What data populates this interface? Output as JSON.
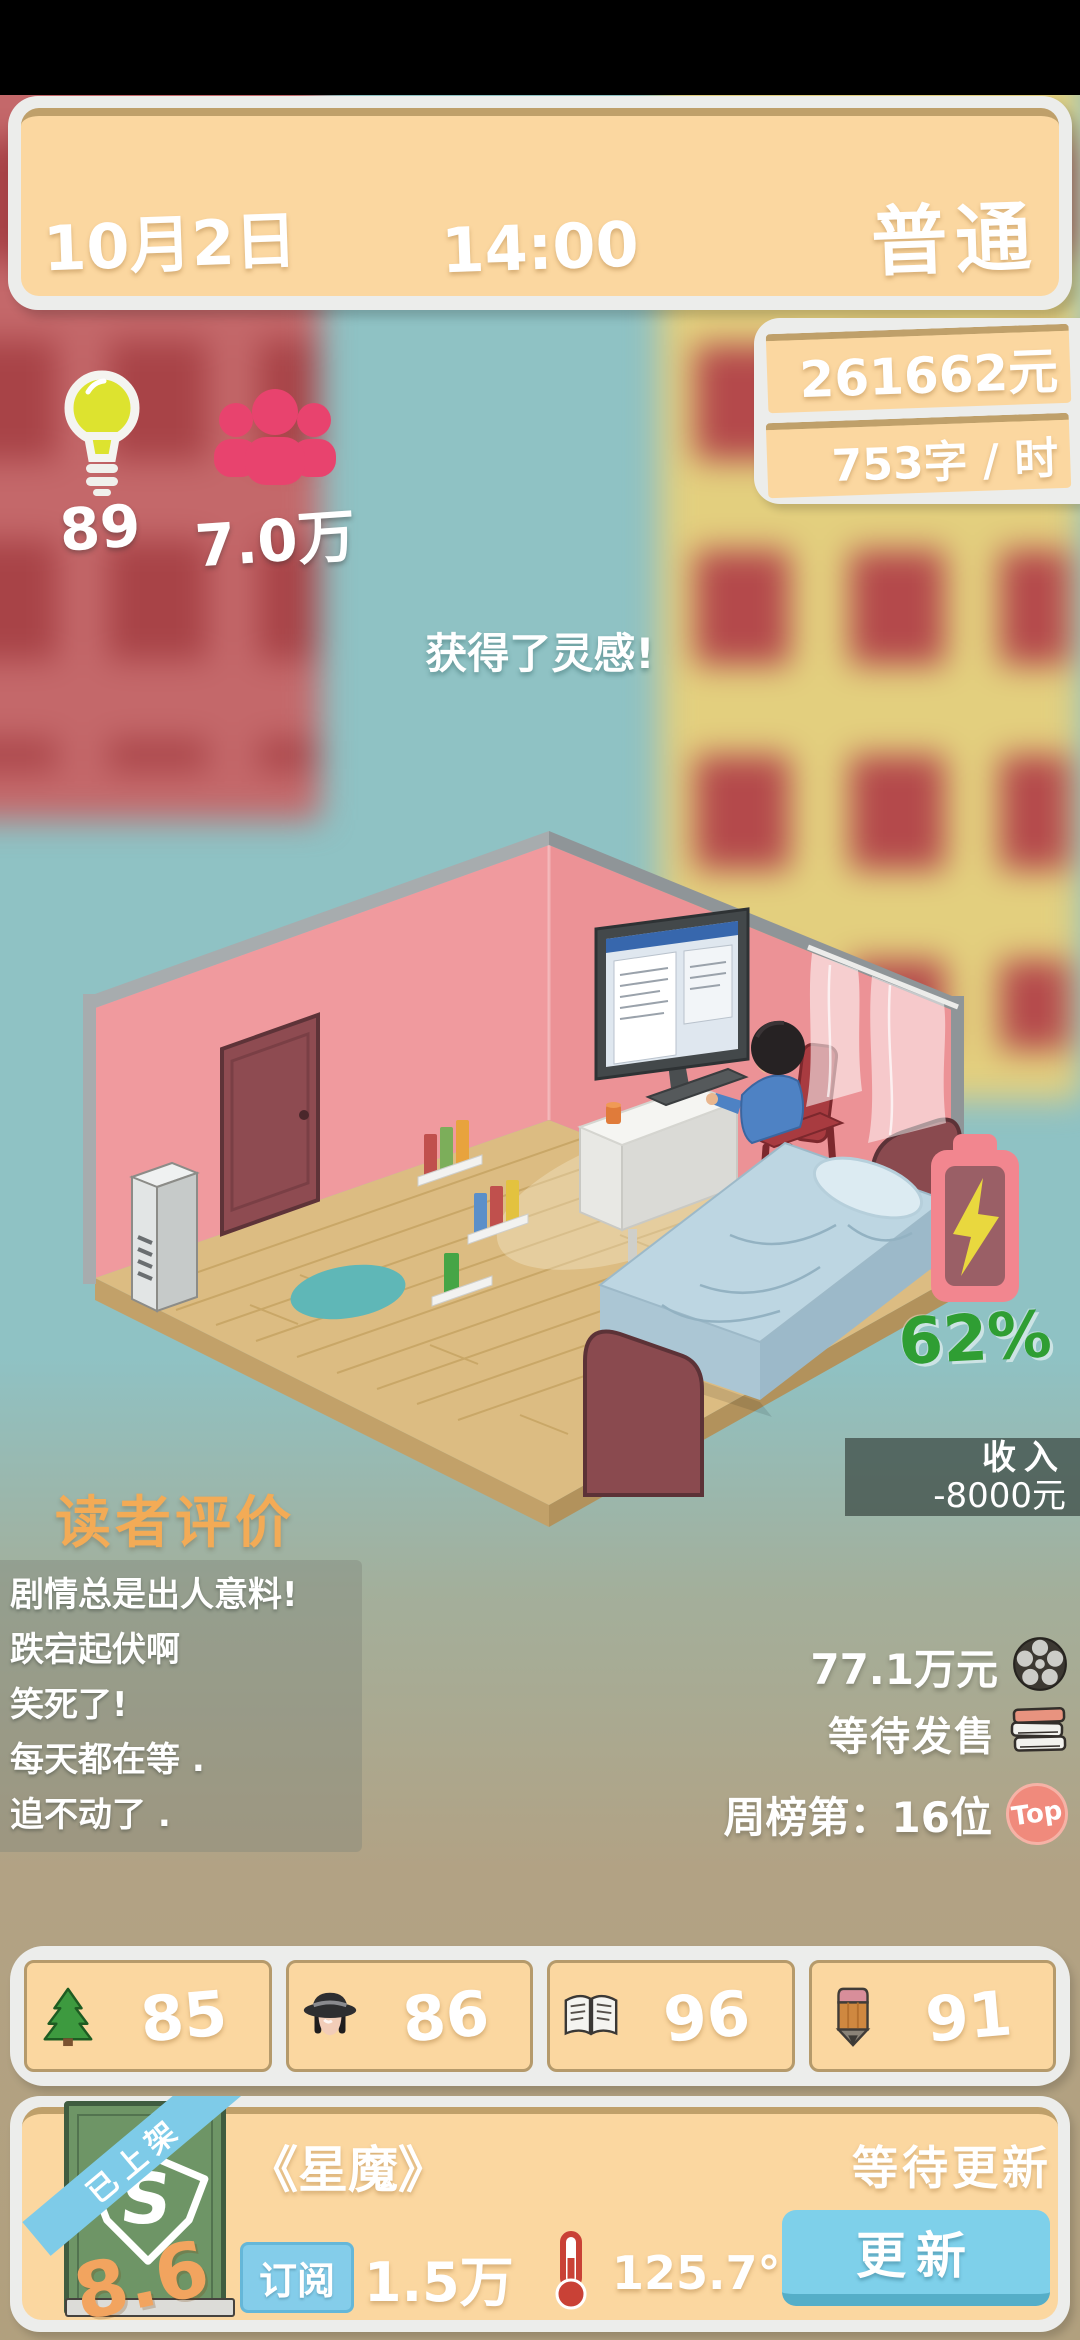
{
  "header": {
    "date": "10月2日",
    "time": "14:00",
    "condition": "普通"
  },
  "wallet": {
    "money": "261662元",
    "writing_speed": "753字 / 时"
  },
  "counters": {
    "inspiration": "89",
    "fans": "7.0万"
  },
  "toast": {
    "message": "获得了灵感!"
  },
  "energy": {
    "percent": "62%"
  },
  "income": {
    "label": "收入",
    "value": "-8000元"
  },
  "reviews": {
    "title": "读者评价",
    "comments": [
      "剧情总是出人意料!",
      "跌宕起伏啊",
      "笑死了!",
      "每天都在等 .",
      "追不动了 ."
    ]
  },
  "market": {
    "adaptation_value": "77.1万元",
    "release_status": "等待发售",
    "weekly_rank": "周榜第：16位",
    "top_badge": "Top"
  },
  "stats": {
    "items": [
      {
        "name": "environment",
        "value": "85"
      },
      {
        "name": "appearance",
        "value": "86"
      },
      {
        "name": "knowledge",
        "value": "96"
      },
      {
        "name": "writing",
        "value": "91"
      }
    ]
  },
  "book": {
    "ribbon": "已上架",
    "rating": "8.6",
    "cover_monogram": "S",
    "title": "《星魔》",
    "status": "等待更新",
    "subscribe_label": "订阅",
    "subscribers": "1.5万",
    "heat": "125.7°",
    "update_button": "更新"
  },
  "colors": {
    "panel_orange": "#fbd7a0",
    "panel_trim_tan": "#bfa06a",
    "panel_white": "#ecedeb",
    "accent_blue": "#7ed0ea",
    "rating_orange": "#f2a45f",
    "energy_green": "#2f9e33",
    "fans_pink": "#e8436e",
    "battery_pink": "#f2868f",
    "reviews_title_orange": "#f3ab56"
  }
}
